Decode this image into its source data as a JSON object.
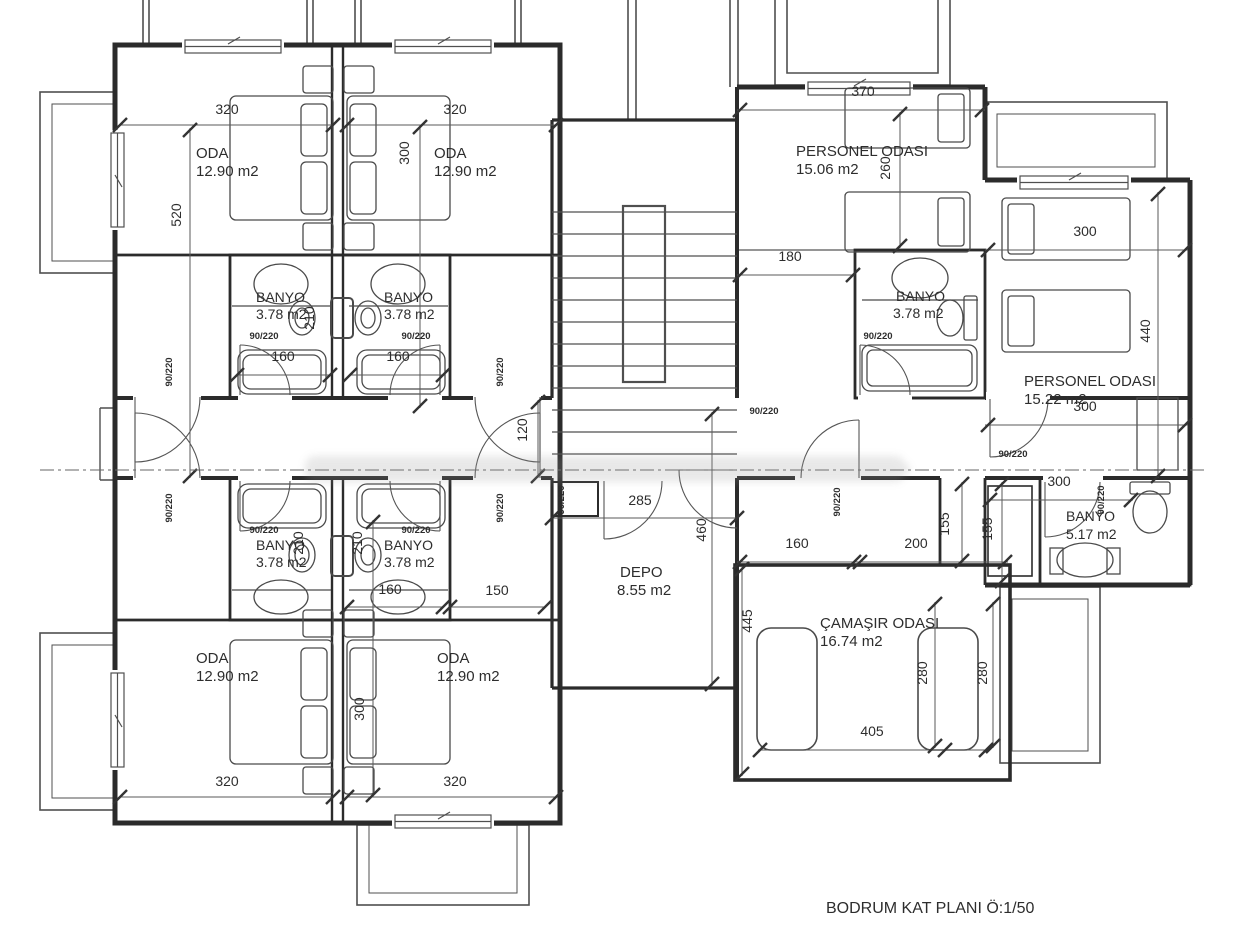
{
  "title": "BODRUM KAT PLANI Ö:1/50",
  "colors": {
    "line": "#2b2b2b",
    "thin_line": "#5a5a5a",
    "text": "#2d2d2d",
    "watermark": "#a9a9a9",
    "background": "#ffffff"
  },
  "rooms": [
    {
      "name": "ODA",
      "area": "12.90 m2",
      "count": 4
    },
    {
      "name": "BANYO",
      "area": "3.78 m2",
      "count": 5
    },
    {
      "name": "PERSONEL ODASI",
      "area": "15.06 m2"
    },
    {
      "name": "PERSONEL ODASI",
      "area": "15.22 m2"
    },
    {
      "name": "BANYO",
      "area": "5.17 m2"
    },
    {
      "name": "DEPO",
      "area": "8.55 m2"
    },
    {
      "name": "ÇAMAŞIR ODASI",
      "area": "16.74 m2"
    }
  ],
  "door_size_label": "90/220",
  "caption": "BODRUM KAT PLANI Ö:1/50",
  "labels": [
    {
      "n": "room-oda-tl-name",
      "t": "ODA",
      "x": 196,
      "y": 158,
      "a": "start",
      "s": 15
    },
    {
      "n": "room-oda-tl-area",
      "t": "12.90 m2",
      "x": 196,
      "y": 176,
      "a": "start",
      "s": 15
    },
    {
      "n": "room-oda-tr-name",
      "t": "ODA",
      "x": 434,
      "y": 158,
      "a": "start",
      "s": 15
    },
    {
      "n": "room-oda-tr-area",
      "t": "12.90 m2",
      "x": 434,
      "y": 176,
      "a": "start",
      "s": 15
    },
    {
      "n": "room-oda-bl-name",
      "t": "ODA",
      "x": 196,
      "y": 663,
      "a": "start",
      "s": 15
    },
    {
      "n": "room-oda-bl-area",
      "t": "12.90 m2",
      "x": 196,
      "y": 681,
      "a": "start",
      "s": 15
    },
    {
      "n": "room-oda-br-name",
      "t": "ODA",
      "x": 437,
      "y": 663,
      "a": "start",
      "s": 15
    },
    {
      "n": "room-oda-br-area",
      "t": "12.90 m2",
      "x": 437,
      "y": 681,
      "a": "start",
      "s": 15
    },
    {
      "n": "room-personel1-name",
      "t": "PERSONEL ODASI",
      "x": 796,
      "y": 156,
      "a": "start",
      "s": 15
    },
    {
      "n": "room-personel1-area",
      "t": "15.06 m2",
      "x": 796,
      "y": 174,
      "a": "start",
      "s": 15
    },
    {
      "n": "room-personel2-name",
      "t": "PERSONEL ODASI",
      "x": 1024,
      "y": 386,
      "a": "start",
      "s": 15
    },
    {
      "n": "room-personel2-area",
      "t": "15.22 m2",
      "x": 1024,
      "y": 404,
      "a": "start",
      "s": 15
    },
    {
      "n": "room-banyo-tl-name",
      "t": "BANYO",
      "x": 256,
      "y": 302,
      "a": "start",
      "s": 14
    },
    {
      "n": "room-banyo-tl-area",
      "t": "3.78 m2",
      "x": 256,
      "y": 319,
      "a": "start",
      "s": 14
    },
    {
      "n": "room-banyo-tr-name",
      "t": "BANYO",
      "x": 384,
      "y": 302,
      "a": "start",
      "s": 14
    },
    {
      "n": "room-banyo-tr-area",
      "t": "3.78 m2",
      "x": 384,
      "y": 319,
      "a": "start",
      "s": 14
    },
    {
      "n": "room-banyo-bl-name",
      "t": "BANYO",
      "x": 256,
      "y": 550,
      "a": "start",
      "s": 14
    },
    {
      "n": "room-banyo-bl-area",
      "t": "3.78 m2",
      "x": 256,
      "y": 567,
      "a": "start",
      "s": 14
    },
    {
      "n": "room-banyo-br-name",
      "t": "BANYO",
      "x": 384,
      "y": 550,
      "a": "start",
      "s": 14
    },
    {
      "n": "room-banyo-br-area",
      "t": "3.78 m2",
      "x": 384,
      "y": 567,
      "a": "start",
      "s": 14
    },
    {
      "n": "room-banyo-r-name",
      "t": "BANYO",
      "x": 896,
      "y": 301,
      "a": "start",
      "s": 14
    },
    {
      "n": "room-banyo-r-area",
      "t": "3.78 m2",
      "x": 893,
      "y": 318,
      "a": "start",
      "s": 14
    },
    {
      "n": "room-banyo5-name",
      "t": "BANYO",
      "x": 1066,
      "y": 521,
      "a": "start",
      "s": 14
    },
    {
      "n": "room-banyo5-area",
      "t": "5.17 m2",
      "x": 1066,
      "y": 539,
      "a": "start",
      "s": 14
    },
    {
      "n": "room-depo-name",
      "t": "DEPO",
      "x": 620,
      "y": 577,
      "a": "start",
      "s": 15
    },
    {
      "n": "room-depo-area",
      "t": "8.55 m2",
      "x": 617,
      "y": 595,
      "a": "start",
      "s": 15
    },
    {
      "n": "room-camasir-name",
      "t": "ÇAMAŞIR ODASI",
      "x": 820,
      "y": 628,
      "a": "start",
      "s": 15
    },
    {
      "n": "room-camasir-area",
      "t": "16.74 m2",
      "x": 820,
      "y": 646,
      "a": "start",
      "s": 15
    },
    {
      "n": "plan-caption",
      "t": "BODRUM KAT PLANI Ö:1/50",
      "x": 826,
      "y": 913,
      "a": "start",
      "s": 16
    },
    {
      "n": "dim-320-tl",
      "t": "320",
      "x": 227,
      "y": 114
    },
    {
      "n": "dim-320-tr",
      "t": "320",
      "x": 455,
      "y": 114
    },
    {
      "n": "dim-520",
      "t": "520",
      "x": 181,
      "y": 215,
      "r": -90
    },
    {
      "n": "dim-300-top",
      "t": "300",
      "x": 409,
      "y": 153,
      "r": -90
    },
    {
      "n": "dim-160-tl",
      "t": "160",
      "x": 283,
      "y": 361
    },
    {
      "n": "dim-160-tr",
      "t": "160",
      "x": 398,
      "y": 361
    },
    {
      "n": "dim-210-top",
      "t": "210",
      "x": 314,
      "y": 318,
      "r": -90
    },
    {
      "n": "dim-320-bl",
      "t": "320",
      "x": 227,
      "y": 786
    },
    {
      "n": "dim-320-br",
      "t": "320",
      "x": 455,
      "y": 786
    },
    {
      "n": "dim-300-bottom",
      "t": "300",
      "x": 364,
      "y": 709,
      "r": -90
    },
    {
      "n": "dim-210-bl",
      "t": "210",
      "x": 303,
      "y": 543,
      "r": -90
    },
    {
      "n": "dim-210-br",
      "t": "210",
      "x": 362,
      "y": 543,
      "r": -90
    },
    {
      "n": "dim-160-bottom",
      "t": "160",
      "x": 390,
      "y": 594
    },
    {
      "n": "dim-150",
      "t": "150",
      "x": 497,
      "y": 595
    },
    {
      "n": "dim-120",
      "t": "120",
      "x": 527,
      "y": 430,
      "r": -90
    },
    {
      "n": "dim-285",
      "t": "285",
      "x": 640,
      "y": 505
    },
    {
      "n": "dim-460",
      "t": "460",
      "x": 706,
      "y": 530,
      "r": -90
    },
    {
      "n": "dim-370",
      "t": "370",
      "x": 863,
      "y": 96
    },
    {
      "n": "dim-260",
      "t": "260",
      "x": 890,
      "y": 168,
      "r": -90
    },
    {
      "n": "dim-180",
      "t": "180",
      "x": 790,
      "y": 261
    },
    {
      "n": "dim-300-r1",
      "t": "300",
      "x": 1085,
      "y": 236
    },
    {
      "n": "dim-440",
      "t": "440",
      "x": 1150,
      "y": 331,
      "r": -90
    },
    {
      "n": "dim-300-r2",
      "t": "300",
      "x": 1085,
      "y": 411
    },
    {
      "n": "dim-300-r3",
      "t": "300",
      "x": 1059,
      "y": 486
    },
    {
      "n": "dim-155-a",
      "t": "155",
      "x": 949,
      "y": 524,
      "r": -90
    },
    {
      "n": "dim-155-b",
      "t": "155",
      "x": 992,
      "y": 529,
      "r": -90
    },
    {
      "n": "dim-160-right",
      "t": "160",
      "x": 797,
      "y": 548
    },
    {
      "n": "dim-200",
      "t": "200",
      "x": 916,
      "y": 548
    },
    {
      "n": "dim-445",
      "t": "445",
      "x": 752,
      "y": 621,
      "r": -90
    },
    {
      "n": "dim-280-a",
      "t": "280",
      "x": 927,
      "y": 673,
      "r": -90
    },
    {
      "n": "dim-280-b",
      "t": "280",
      "x": 987,
      "y": 673,
      "r": -90
    },
    {
      "n": "dim-405",
      "t": "405",
      "x": 872,
      "y": 736
    },
    {
      "n": "door-label-vest-tl",
      "t": "90/220",
      "x": 172,
      "y": 372,
      "r": -90,
      "s": 9.5,
      "w": "bold"
    },
    {
      "n": "door-label-vest-tr",
      "t": "90/220",
      "x": 503,
      "y": 372,
      "r": -90,
      "s": 9.5,
      "w": "bold"
    },
    {
      "n": "door-label-vest-bl",
      "t": "90/220",
      "x": 172,
      "y": 508,
      "r": -90,
      "s": 9.5,
      "w": "bold"
    },
    {
      "n": "door-label-vest-br",
      "t": "90/220",
      "x": 503,
      "y": 508,
      "r": -90,
      "s": 9.5,
      "w": "bold"
    },
    {
      "n": "door-label-bath-tl",
      "t": "90/220",
      "x": 264,
      "y": 339,
      "s": 9.5,
      "w": "bold"
    },
    {
      "n": "door-label-bath-tr",
      "t": "90/220",
      "x": 416,
      "y": 339,
      "s": 9.5,
      "w": "bold"
    },
    {
      "n": "door-label-bath-bl",
      "t": "90/220",
      "x": 264,
      "y": 533,
      "s": 9.5,
      "w": "bold"
    },
    {
      "n": "door-label-bath-br",
      "t": "90/220",
      "x": 416,
      "y": 533,
      "s": 9.5,
      "w": "bold"
    },
    {
      "n": "door-label-bath-r",
      "t": "90/220",
      "x": 878,
      "y": 339,
      "s": 9.5,
      "w": "bold"
    },
    {
      "n": "door-label-stair",
      "t": "90/220",
      "x": 764,
      "y": 414,
      "s": 9.5,
      "w": "bold"
    },
    {
      "n": "door-label-depo",
      "t": "90/220",
      "x": 564,
      "y": 500,
      "r": -90,
      "s": 9.5,
      "w": "bold"
    },
    {
      "n": "door-label-corridor-r",
      "t": "90/220",
      "x": 840,
      "y": 502,
      "r": -90,
      "s": 9.5,
      "w": "bold"
    },
    {
      "n": "door-label-personel2",
      "t": "90/220",
      "x": 1013,
      "y": 457,
      "s": 9.5,
      "w": "bold"
    },
    {
      "n": "door-label-banyo5",
      "t": "90/220",
      "x": 1104,
      "y": 500,
      "r": -90,
      "s": 9.5,
      "w": "bold"
    }
  ]
}
